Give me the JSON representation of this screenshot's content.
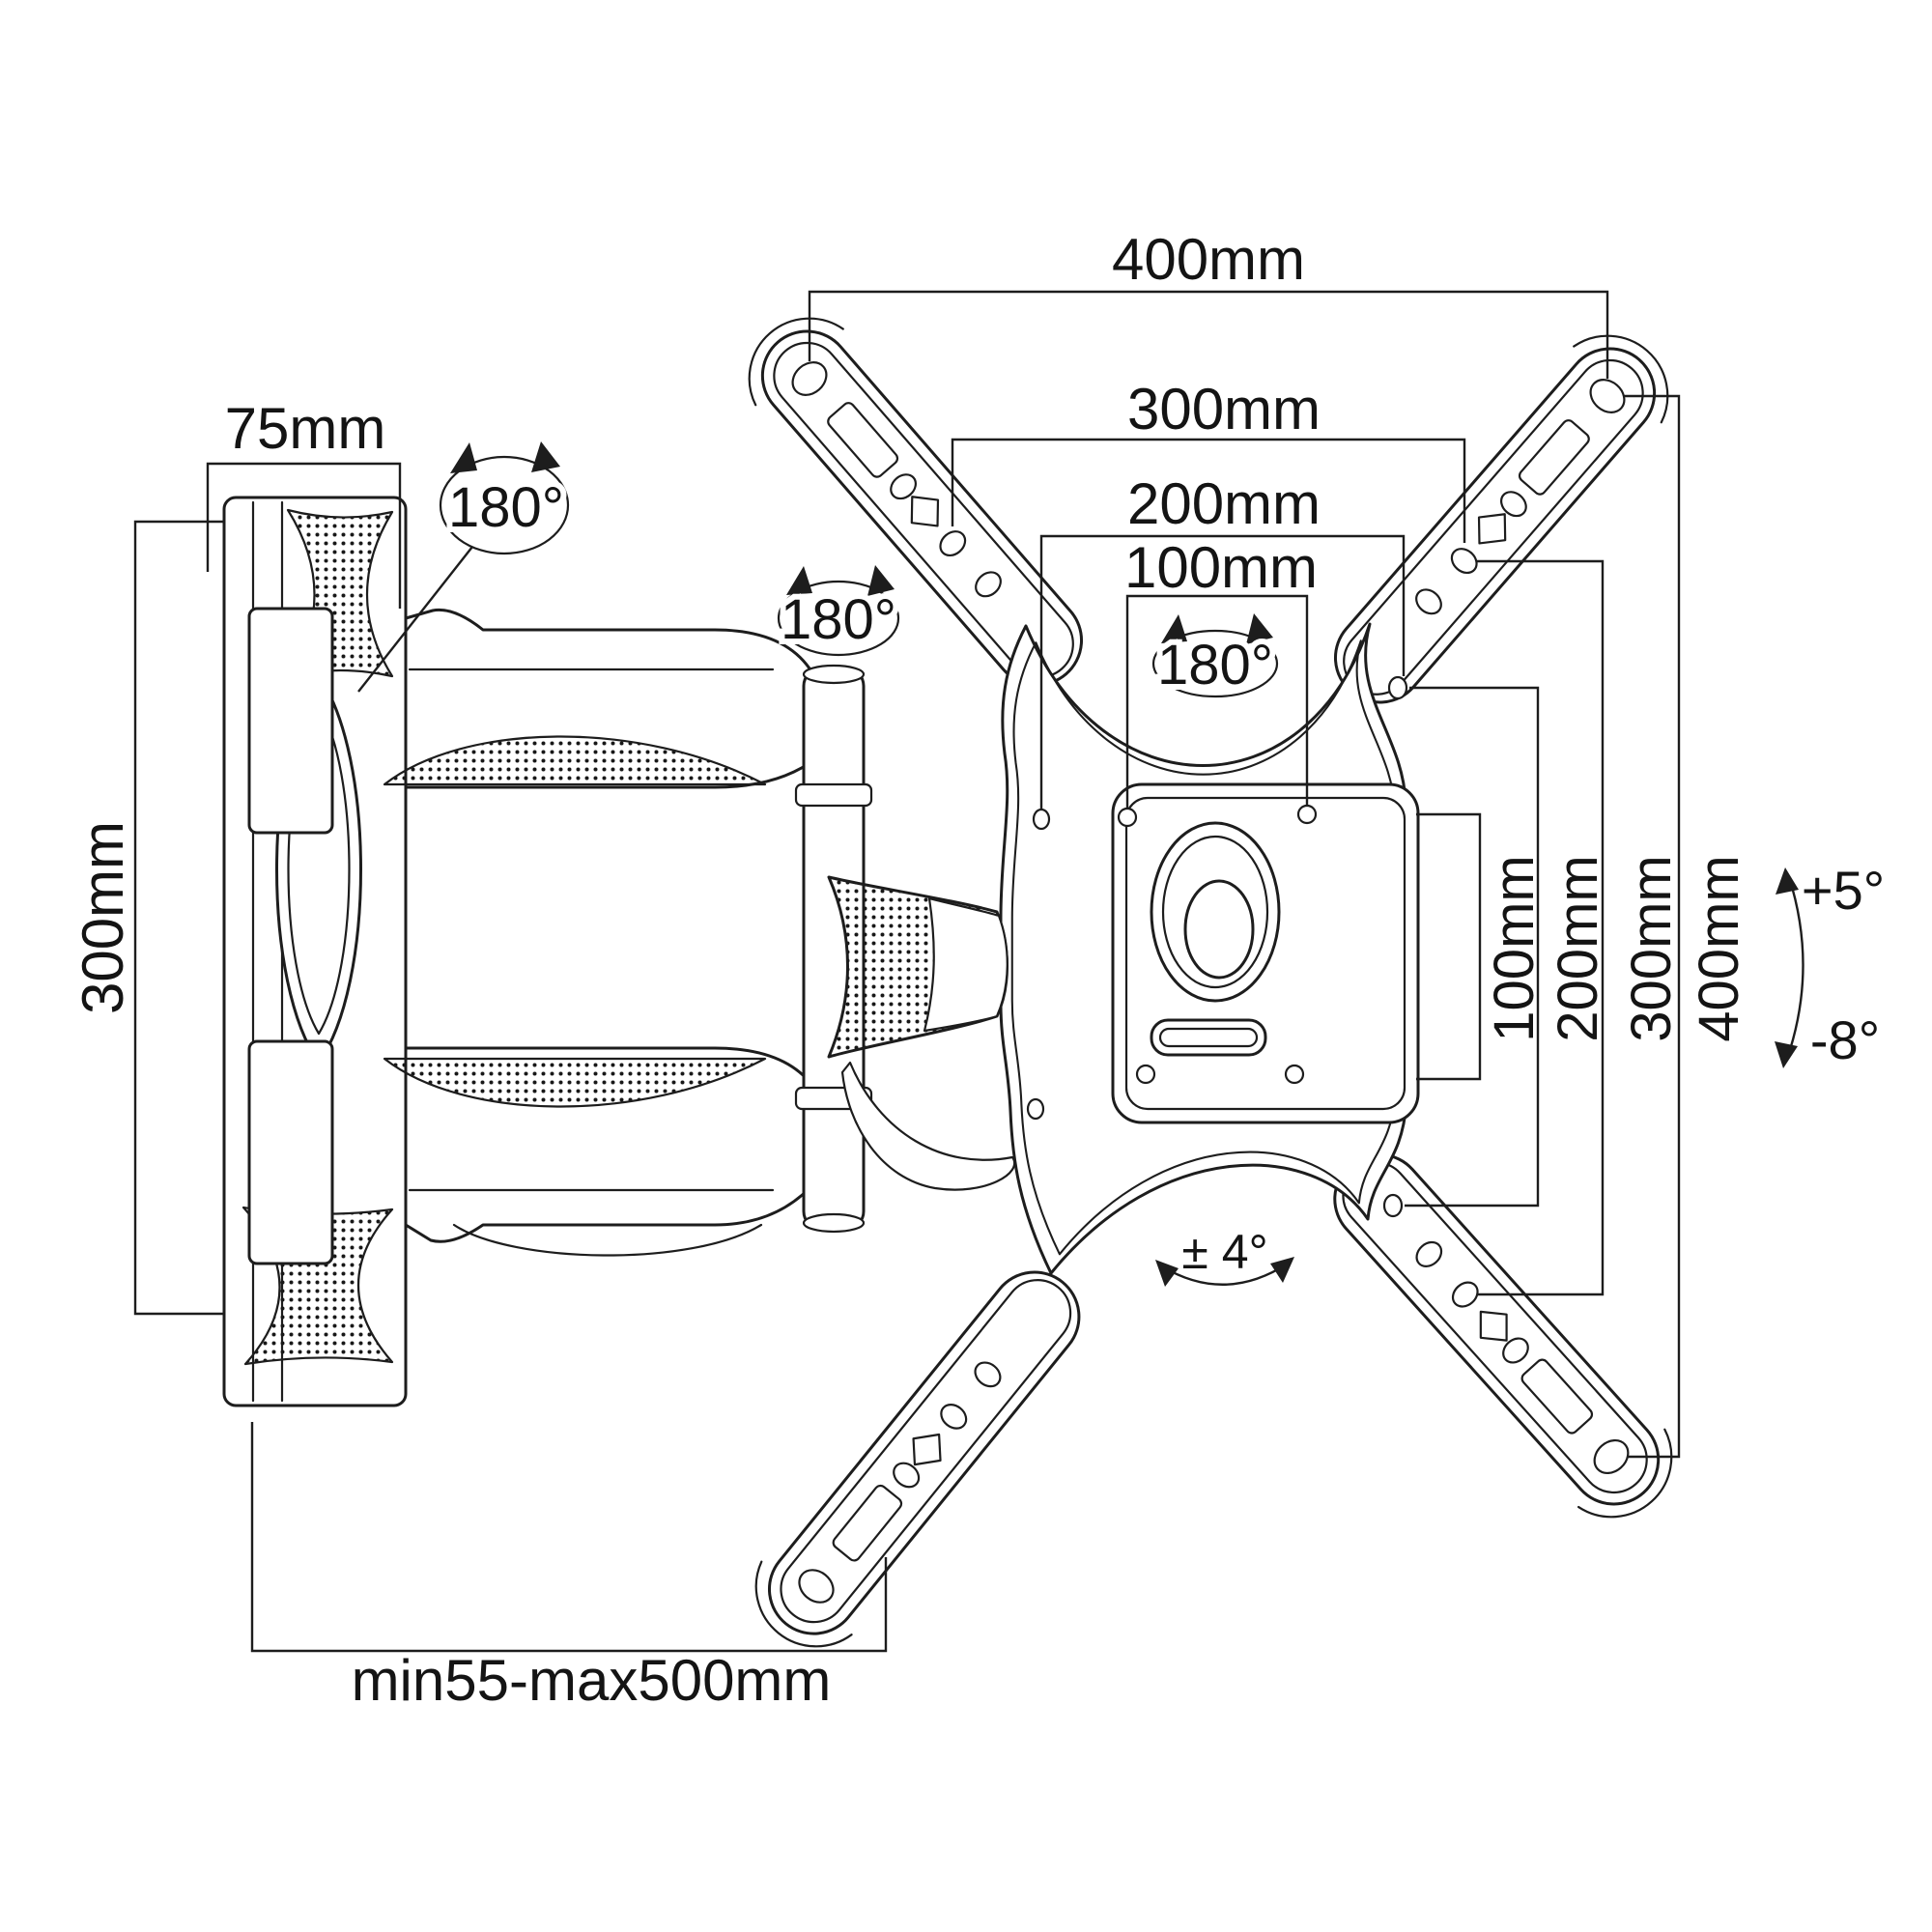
{
  "drawing": "wall-mount-dimension-diagram",
  "dims": {
    "top_400": "400mm",
    "top_300": "300mm",
    "top_200": "200mm",
    "top_100": "100mm",
    "wall_width": "75mm",
    "wall_height": "300mm",
    "right_100": "100mm",
    "right_200": "200mm",
    "right_300": "300mm",
    "right_400": "400mm",
    "extension": "min55-max500mm"
  },
  "angles": {
    "swivel_wall": "180°",
    "swivel_arm": "180°",
    "swivel_plate": "180°",
    "tilt_up": "+5°",
    "tilt_down": "-8°",
    "level": "± 4°"
  },
  "colors": {
    "background": "#ffffff",
    "line": "#1d1d1d"
  }
}
